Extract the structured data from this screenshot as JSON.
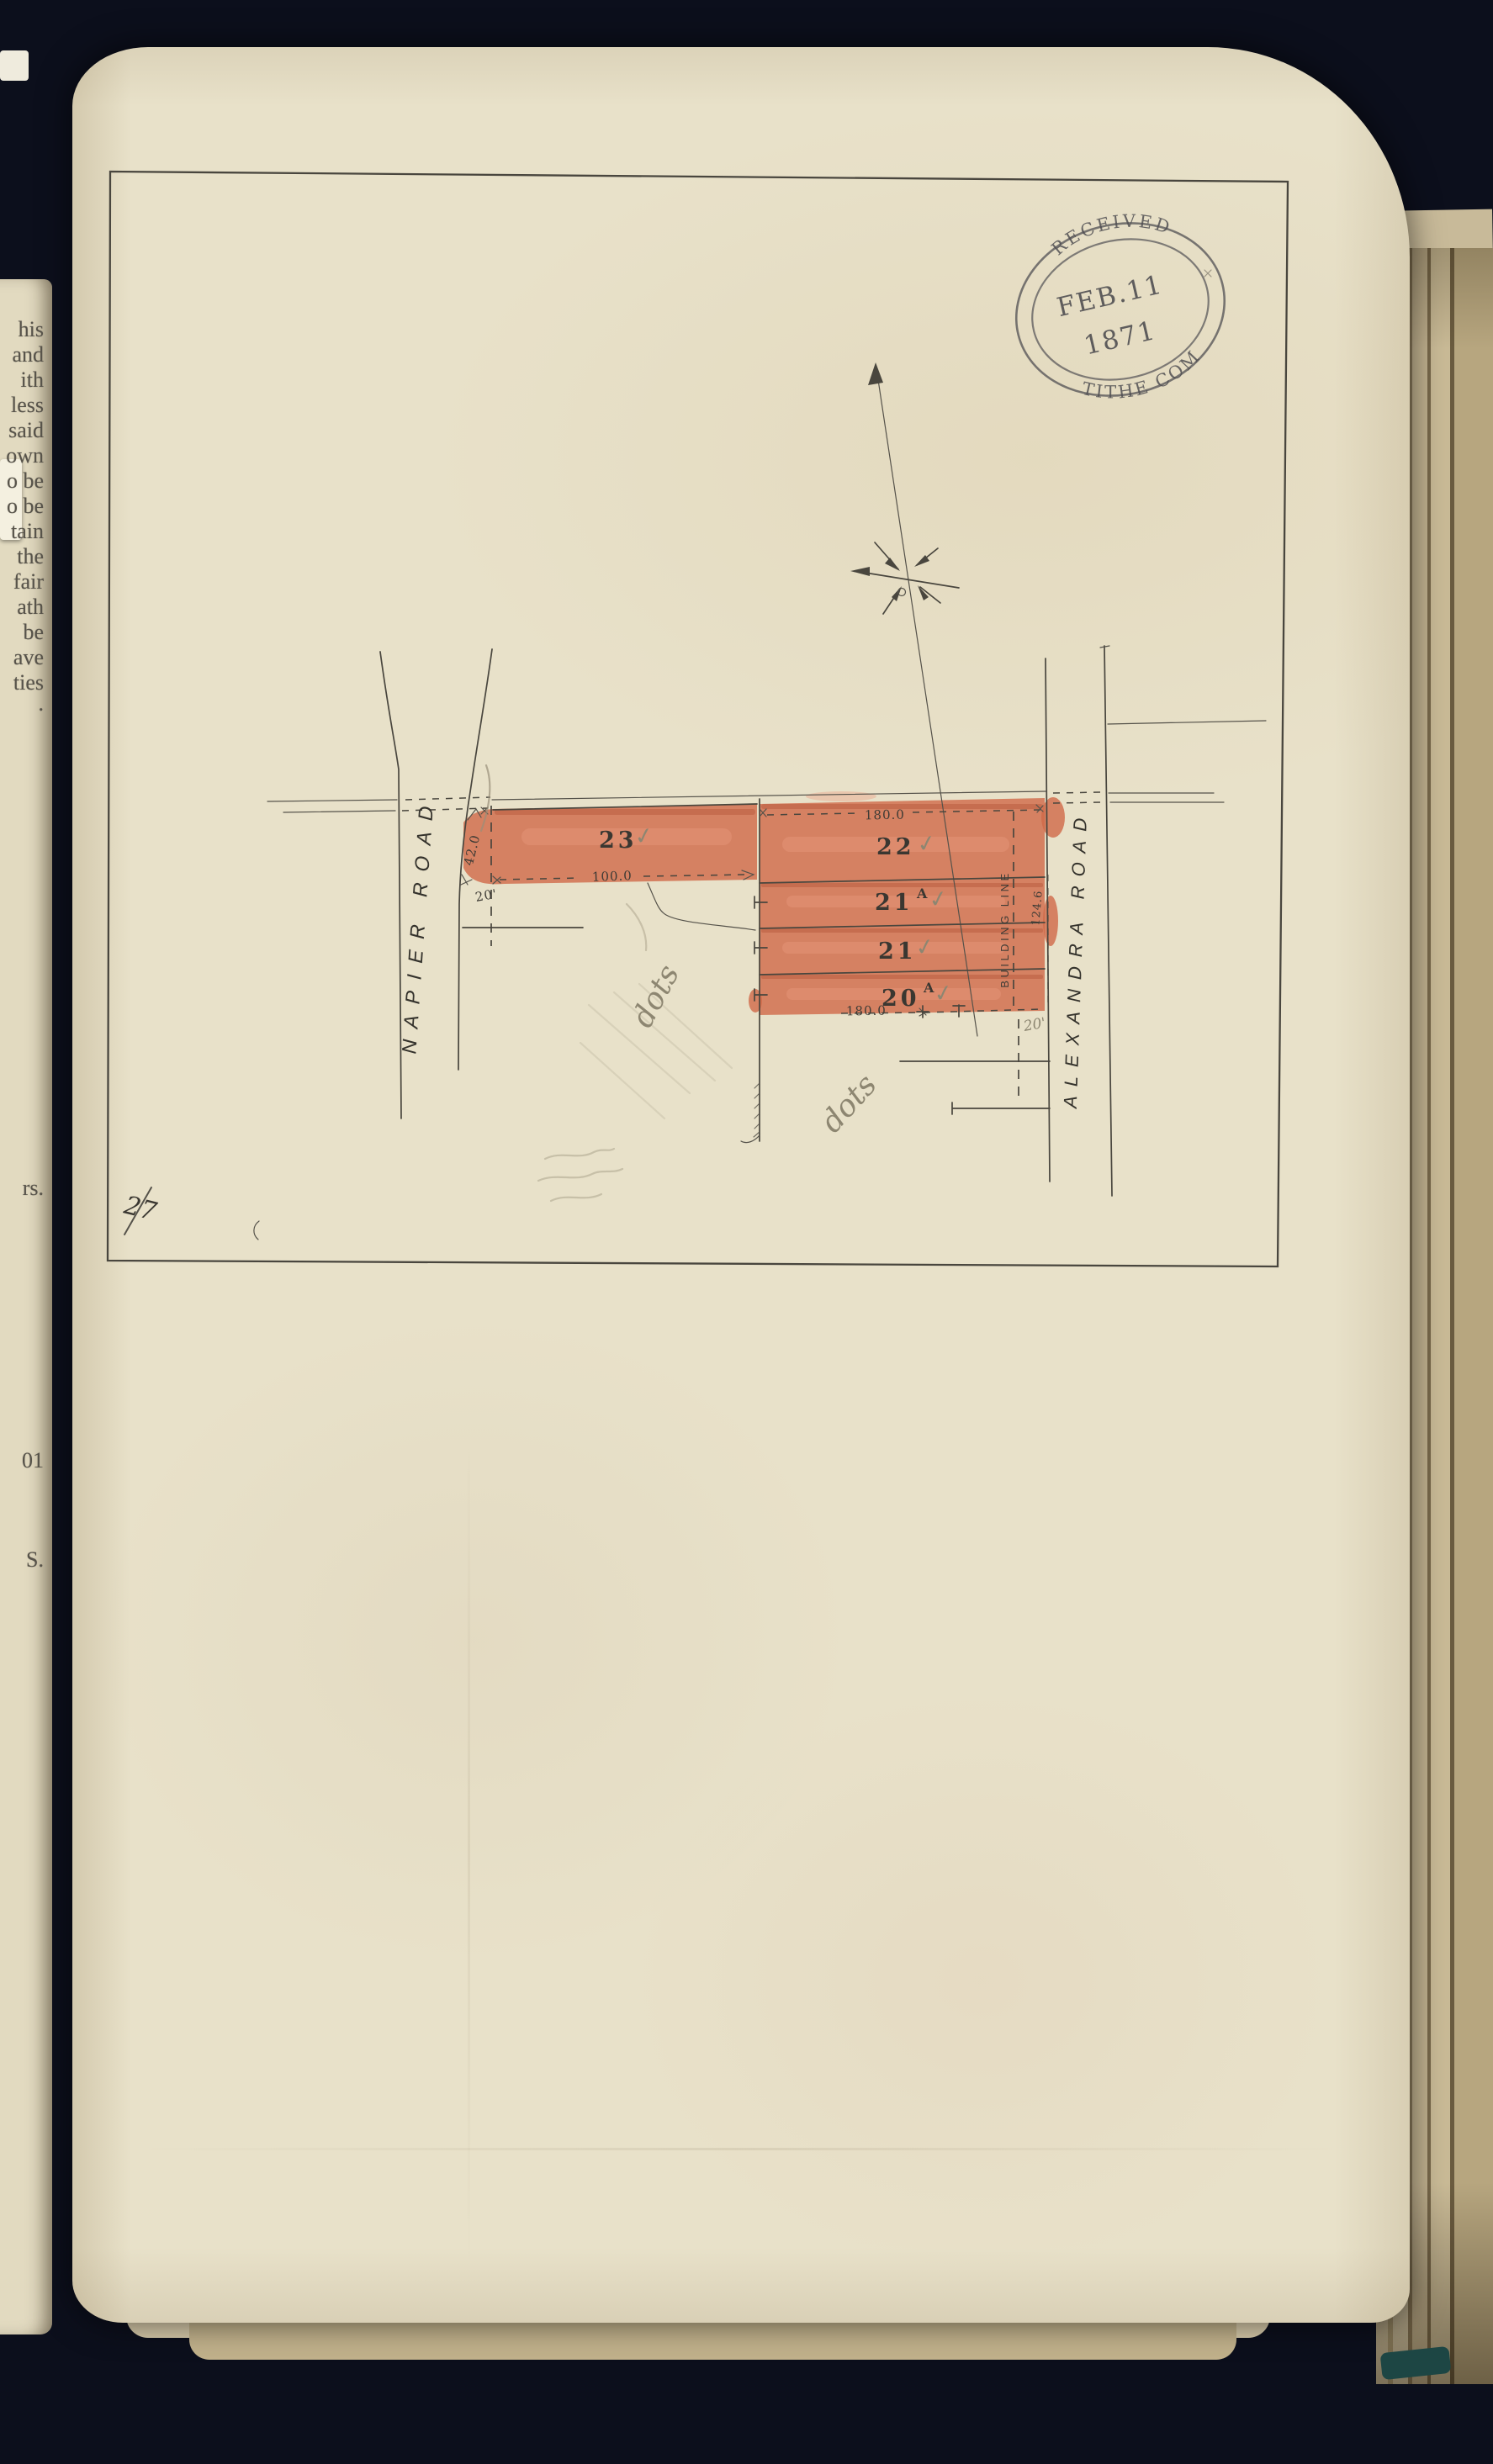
{
  "left_page_fragments": [
    "his",
    "and",
    "ith",
    "less",
    "said",
    "own",
    "o be",
    "o be",
    "tain",
    "the",
    "fair",
    "ath",
    "be",
    "ave",
    "ties",
    ".",
    "rs.",
    "01",
    "S."
  ],
  "stamp": {
    "top": "RECEIVED",
    "date": "FEB.11",
    "year": "1871",
    "bottom": "TITHE COM"
  },
  "plan": {
    "roads": {
      "west": "NAPIER ROAD",
      "east": "ALEXANDRA ROAD"
    },
    "building_line": "BUILDING LINE",
    "lots": [
      {
        "number": "23",
        "check": "✓"
      },
      {
        "number": "22",
        "check": "✓"
      },
      {
        "number": "21",
        "suffix": "A",
        "check": "✓"
      },
      {
        "number": "21",
        "check": "✓"
      },
      {
        "number": "20",
        "suffix": "A",
        "check": "✓"
      }
    ],
    "measurements": {
      "block_top": "180.0",
      "block_bottom": "180.0",
      "lot23_frontage": "100.0",
      "napier_width": "42.0",
      "napier_setback": "20'",
      "building_line_depth": "124.6"
    },
    "pencil": {
      "note_left": "dots",
      "note_right": "dots",
      "lot_depth": "20'",
      "corner": "27"
    }
  }
}
